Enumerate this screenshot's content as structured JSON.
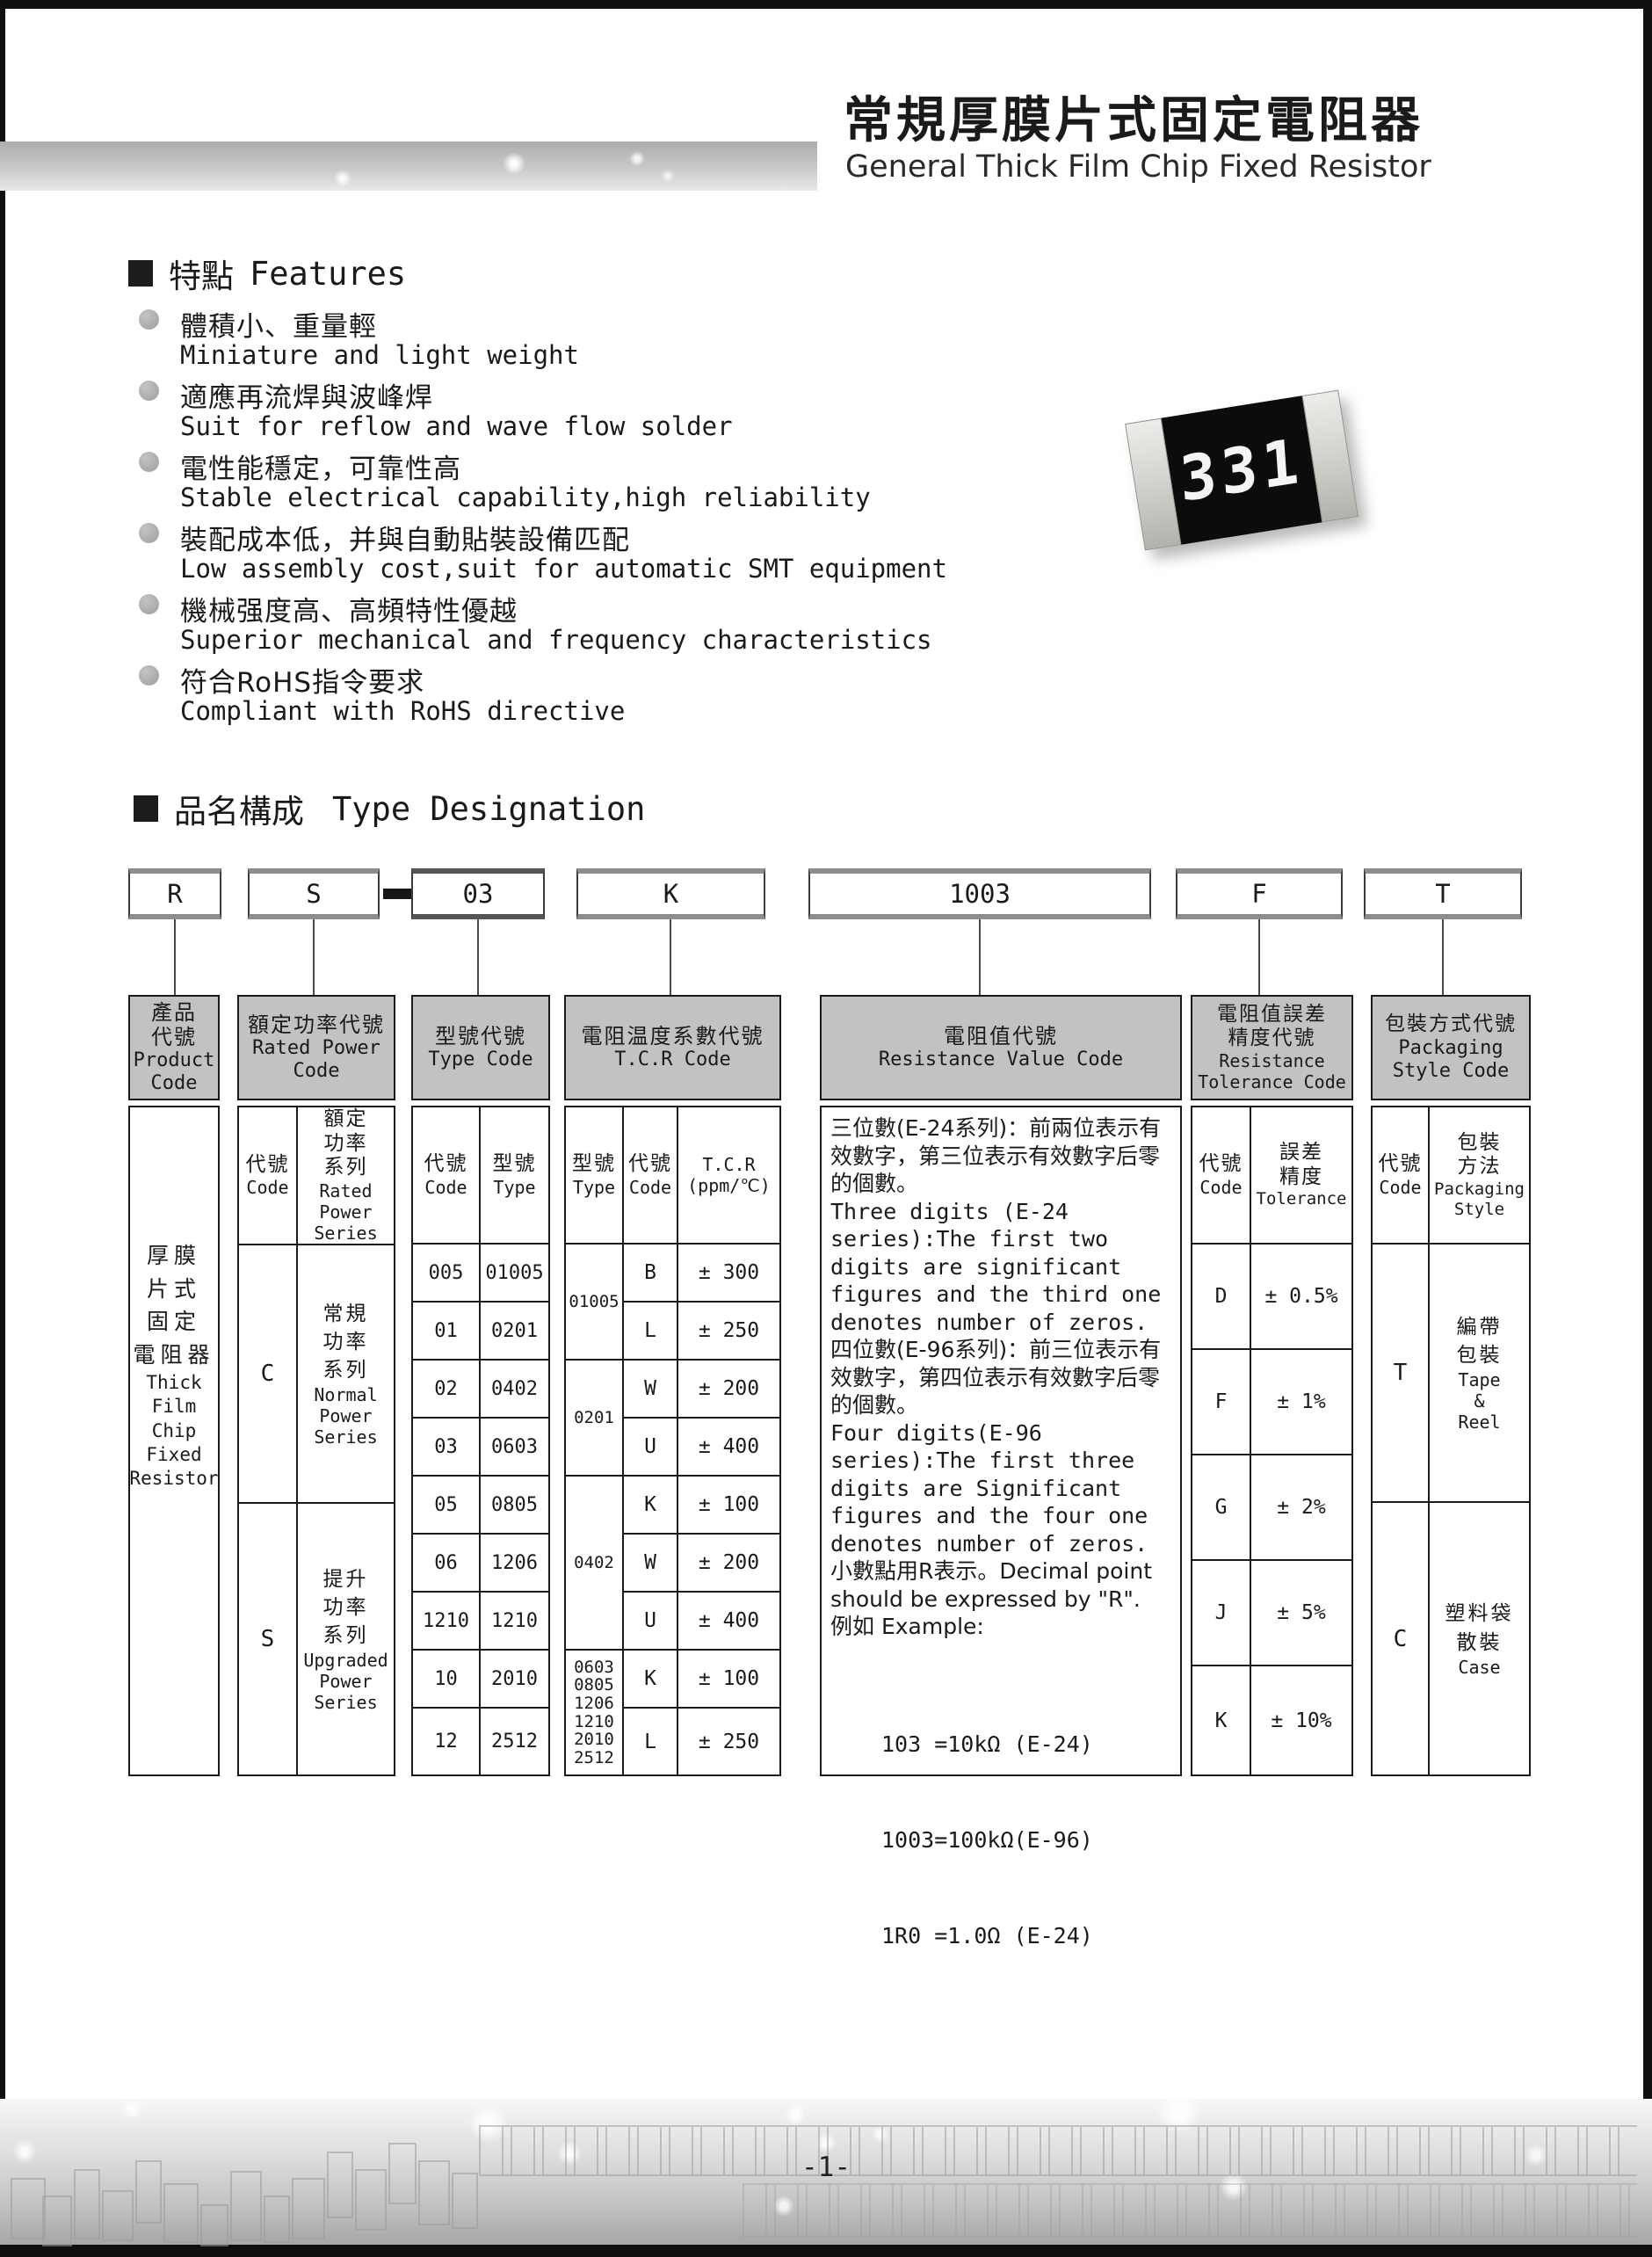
{
  "header": {
    "title_cn": "常規厚膜片式固定電阻器",
    "title_en": "General Thick Film Chip Fixed Resistor"
  },
  "resistor_marking": "331",
  "features": {
    "heading_cn": "特點",
    "heading_en": "Features",
    "items": [
      {
        "cn": "體積小、重量輕",
        "en": "Miniature and light weight"
      },
      {
        "cn": "適應再流焊與波峰焊",
        "en": "Suit for reflow and wave flow solder"
      },
      {
        "cn": "電性能穩定，可靠性高",
        "en": "Stable electrical capability,high reliability"
      },
      {
        "cn": "裝配成本低，并與自動貼裝設備匹配",
        "en": "Low assembly cost,suit for automatic SMT equipment"
      },
      {
        "cn": "機械强度高、高頻特性優越",
        "en": "Superior mechanical and frequency characteristics"
      },
      {
        "cn": "符合RoHS指令要求",
        "en": "Compliant with RoHS directive"
      }
    ]
  },
  "type_designation": {
    "heading_cn": "品名構成",
    "heading_en": "Type Designation",
    "codes": [
      "R",
      "S",
      "03",
      "K",
      "1003",
      "F",
      "T"
    ],
    "separator": "-"
  },
  "columns": {
    "product": {
      "header_cn": "產品\n代號",
      "header_en": "Product\nCode",
      "body_cn": "厚膜\n片式\n固定\n電阻器",
      "body_en": "Thick\nFilm\nChip\nFixed\nResistor"
    },
    "rated_power": {
      "header_cn": "額定功率代號",
      "header_en": "Rated Power\nCode",
      "code_label_cn": "代號",
      "code_label_en": "Code",
      "series_label_cn": "額定\n功率\n系列",
      "series_label_en": "Rated\nPower\nSeries",
      "rows": [
        {
          "code": "C",
          "cn": "常規\n功率\n系列",
          "en": "Normal\nPower\nSeries"
        },
        {
          "code": "S",
          "cn": "提升\n功率\n系列",
          "en": "Upgraded\nPower\nSeries"
        }
      ]
    },
    "type_code": {
      "header_cn": "型號代號",
      "header_en": "Type Code",
      "code_label_cn": "代號",
      "code_label_en": "Code",
      "type_label_cn": "型號",
      "type_label_en": "Type",
      "rows": [
        {
          "code": "005",
          "type": "01005"
        },
        {
          "code": "01",
          "type": "0201"
        },
        {
          "code": "02",
          "type": "0402"
        },
        {
          "code": "03",
          "type": "0603"
        },
        {
          "code": "05",
          "type": "0805"
        },
        {
          "code": "06",
          "type": "1206"
        },
        {
          "code": "1210",
          "type": "1210"
        },
        {
          "code": "10",
          "type": "2010"
        },
        {
          "code": "12",
          "type": "2512"
        }
      ]
    },
    "tcr": {
      "header_cn": "電阻温度系數代號",
      "header_en": "T.C.R Code",
      "type_label_cn": "型號",
      "type_label_en": "Type",
      "code_label_cn": "代號",
      "code_label_en": "Code",
      "tcr_label": "T.C.R\n(ppm/℃)",
      "groups": [
        {
          "type": "01005",
          "rows": [
            {
              "code": "B",
              "value": "± 300"
            },
            {
              "code": "L",
              "value": "± 250"
            }
          ]
        },
        {
          "type": "0201",
          "rows": [
            {
              "code": "W",
              "value": "± 200"
            },
            {
              "code": "U",
              "value": "± 400"
            }
          ]
        },
        {
          "type": "0402",
          "rows": [
            {
              "code": "K",
              "value": "± 100"
            },
            {
              "code": "W",
              "value": "± 200"
            },
            {
              "code": "U",
              "value": "± 400"
            }
          ]
        },
        {
          "type": "0603\n0805\n1206\n1210\n2010\n2512",
          "rows": [
            {
              "code": "K",
              "value": "± 100"
            },
            {
              "code": "L",
              "value": "± 250"
            }
          ]
        }
      ]
    },
    "resistance_value": {
      "header_cn": "電阻值代號",
      "header_en": "Resistance Value Code",
      "p1_cn": "三位數(E-24系列)：前兩位表示有效數字，第三位表示有效數字后零的個數。",
      "p1_en": "Three digits (E-24 series):The first two digits are significant figures and the third one denotes number of zeros.",
      "p2_cn": "四位數(E-96系列)：前三位表示有效數字，第四位表示有效數字后零的個數。",
      "p2_en": "Four digits(E-96 series):The first three digits are Significant figures and the four one denotes number of zeros.",
      "p3": "小數點用R表示。Decimal point should be expressed by \"R\".",
      "example_label": "例如 Example:",
      "examples": [
        "103 =10kΩ (E-24)",
        "1003=100kΩ(E-96)",
        "1R0 =1.0Ω (E-24)"
      ]
    },
    "tolerance": {
      "header_cn": "電阻值誤差\n精度代號",
      "header_en": "Resistance\nTolerance Code",
      "code_label_cn": "代號",
      "code_label_en": "Code",
      "tol_label_cn": "誤差\n精度",
      "tol_label_en": "Tolerance",
      "rows": [
        {
          "code": "D",
          "value": "± 0.5%"
        },
        {
          "code": "F",
          "value": "± 1%"
        },
        {
          "code": "G",
          "value": "± 2%"
        },
        {
          "code": "J",
          "value": "± 5%"
        },
        {
          "code": "K",
          "value": "± 10%"
        }
      ]
    },
    "packaging": {
      "header_cn": "包裝方式代號",
      "header_en": "Packaging\nStyle Code",
      "code_label_cn": "代號",
      "code_label_en": "Code",
      "style_label_cn": "包裝\n方法",
      "style_label_en": "Packaging\nStyle",
      "rows": [
        {
          "code": "T",
          "cn": "編帶\n包裝",
          "en": "Tape\n&\nReel"
        },
        {
          "code": "C",
          "cn": "塑料袋\n散裝",
          "en": "Case"
        }
      ]
    }
  },
  "footer": {
    "page_number": "-1-"
  },
  "colors": {
    "table_header_bg": "#c2c2c2",
    "band_gray": "#adadad",
    "frame_black": "#101010"
  }
}
